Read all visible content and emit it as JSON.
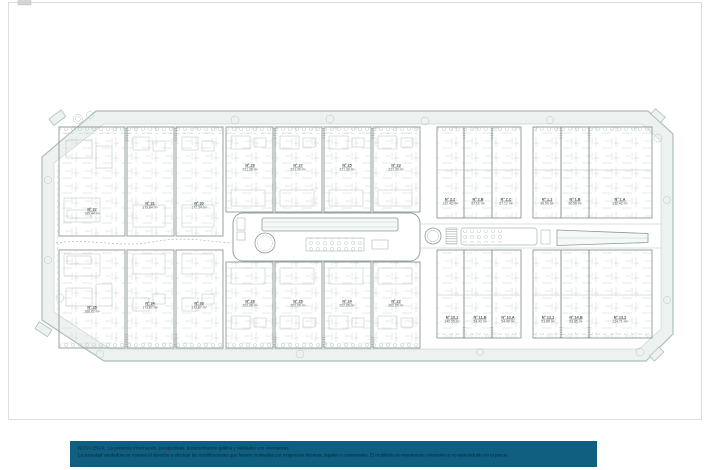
{
  "plan": {
    "site_fill": "#edf2f1",
    "site_stroke": "#aebfbc",
    "line_color": "#8a9997",
    "units": [
      {
        "id": "Nº 32",
        "area": "185.44 m²",
        "x": 92,
        "y": 216
      },
      {
        "id": "Nº 31",
        "area": "173.84 m²",
        "x": 150,
        "y": 210
      },
      {
        "id": "Nº 30",
        "area": "172.34 m²",
        "x": 199,
        "y": 210
      },
      {
        "id": "Nº 29",
        "area": "221.30 m²",
        "x": 250,
        "y": 172
      },
      {
        "id": "Nº 27",
        "area": "221.30 m²",
        "x": 298,
        "y": 172
      },
      {
        "id": "Nº 25",
        "area": "221.30 m²",
        "x": 347,
        "y": 172
      },
      {
        "id": "Nº 23",
        "area": "221.30 m²",
        "x": 396,
        "y": 172
      },
      {
        "id": "Nº 2.2",
        "area": "132.42 m²",
        "x": 450,
        "y": 206
      },
      {
        "id": "Nº 2.B",
        "area": "57.12 m²",
        "x": 478,
        "y": 206
      },
      {
        "id": "Nº 2.C",
        "area": "57.12 m²",
        "x": 506,
        "y": 206
      },
      {
        "id": "Nº 1.1",
        "area": "96.59 m²",
        "x": 547,
        "y": 206
      },
      {
        "id": "Nº 1.B",
        "area": "96.59 m²",
        "x": 575,
        "y": 206
      },
      {
        "id": "Nº 1.A",
        "area": "132.42 m²",
        "x": 620,
        "y": 206
      },
      {
        "id": "Nº 35",
        "area": "188.82 m²",
        "x": 92,
        "y": 314
      },
      {
        "id": "Nº 34",
        "area": "173.87 m²",
        "x": 150,
        "y": 310
      },
      {
        "id": "Nº 33",
        "area": "172.87 m²",
        "x": 199,
        "y": 310
      },
      {
        "id": "Nº 28",
        "area": "202.05 m²",
        "x": 250,
        "y": 308
      },
      {
        "id": "Nº 26",
        "area": "202.05 m²",
        "x": 298,
        "y": 308
      },
      {
        "id": "Nº 24",
        "area": "202.05 m²",
        "x": 347,
        "y": 308
      },
      {
        "id": "Nº 22",
        "area": "202.05 m²",
        "x": 396,
        "y": 308
      },
      {
        "id": "Nº 10.1",
        "area": "142.35 m²",
        "x": 452,
        "y": 324
      },
      {
        "id": "Nº 11.B",
        "area": "54.43 m²",
        "x": 480,
        "y": 324
      },
      {
        "id": "Nº 10.A",
        "area": "54.43 m²",
        "x": 508,
        "y": 324
      },
      {
        "id": "Nº 12.1",
        "area": "53.85 m²",
        "x": 548,
        "y": 324
      },
      {
        "id": "Nº 14.B",
        "area": "53.85 m²",
        "x": 576,
        "y": 324
      },
      {
        "id": "Nº 13.2",
        "area": "124.71 m²",
        "x": 620,
        "y": 324
      }
    ]
  },
  "legal": {
    "band_color": "#0e5f80",
    "text_color": "#0b2438",
    "line1": "NOTA LEGAL: La presente información, perspectivas, documentación gráfica y calidades son orientativas.",
    "line2": "La sociedad vendedora se reserva el derecho a efectuar las modificaciones que fuesen motivadas por exigencias técnicas, legales o comerciales. El mobiliario es meramente orientativo y no está incluido en el precio."
  }
}
